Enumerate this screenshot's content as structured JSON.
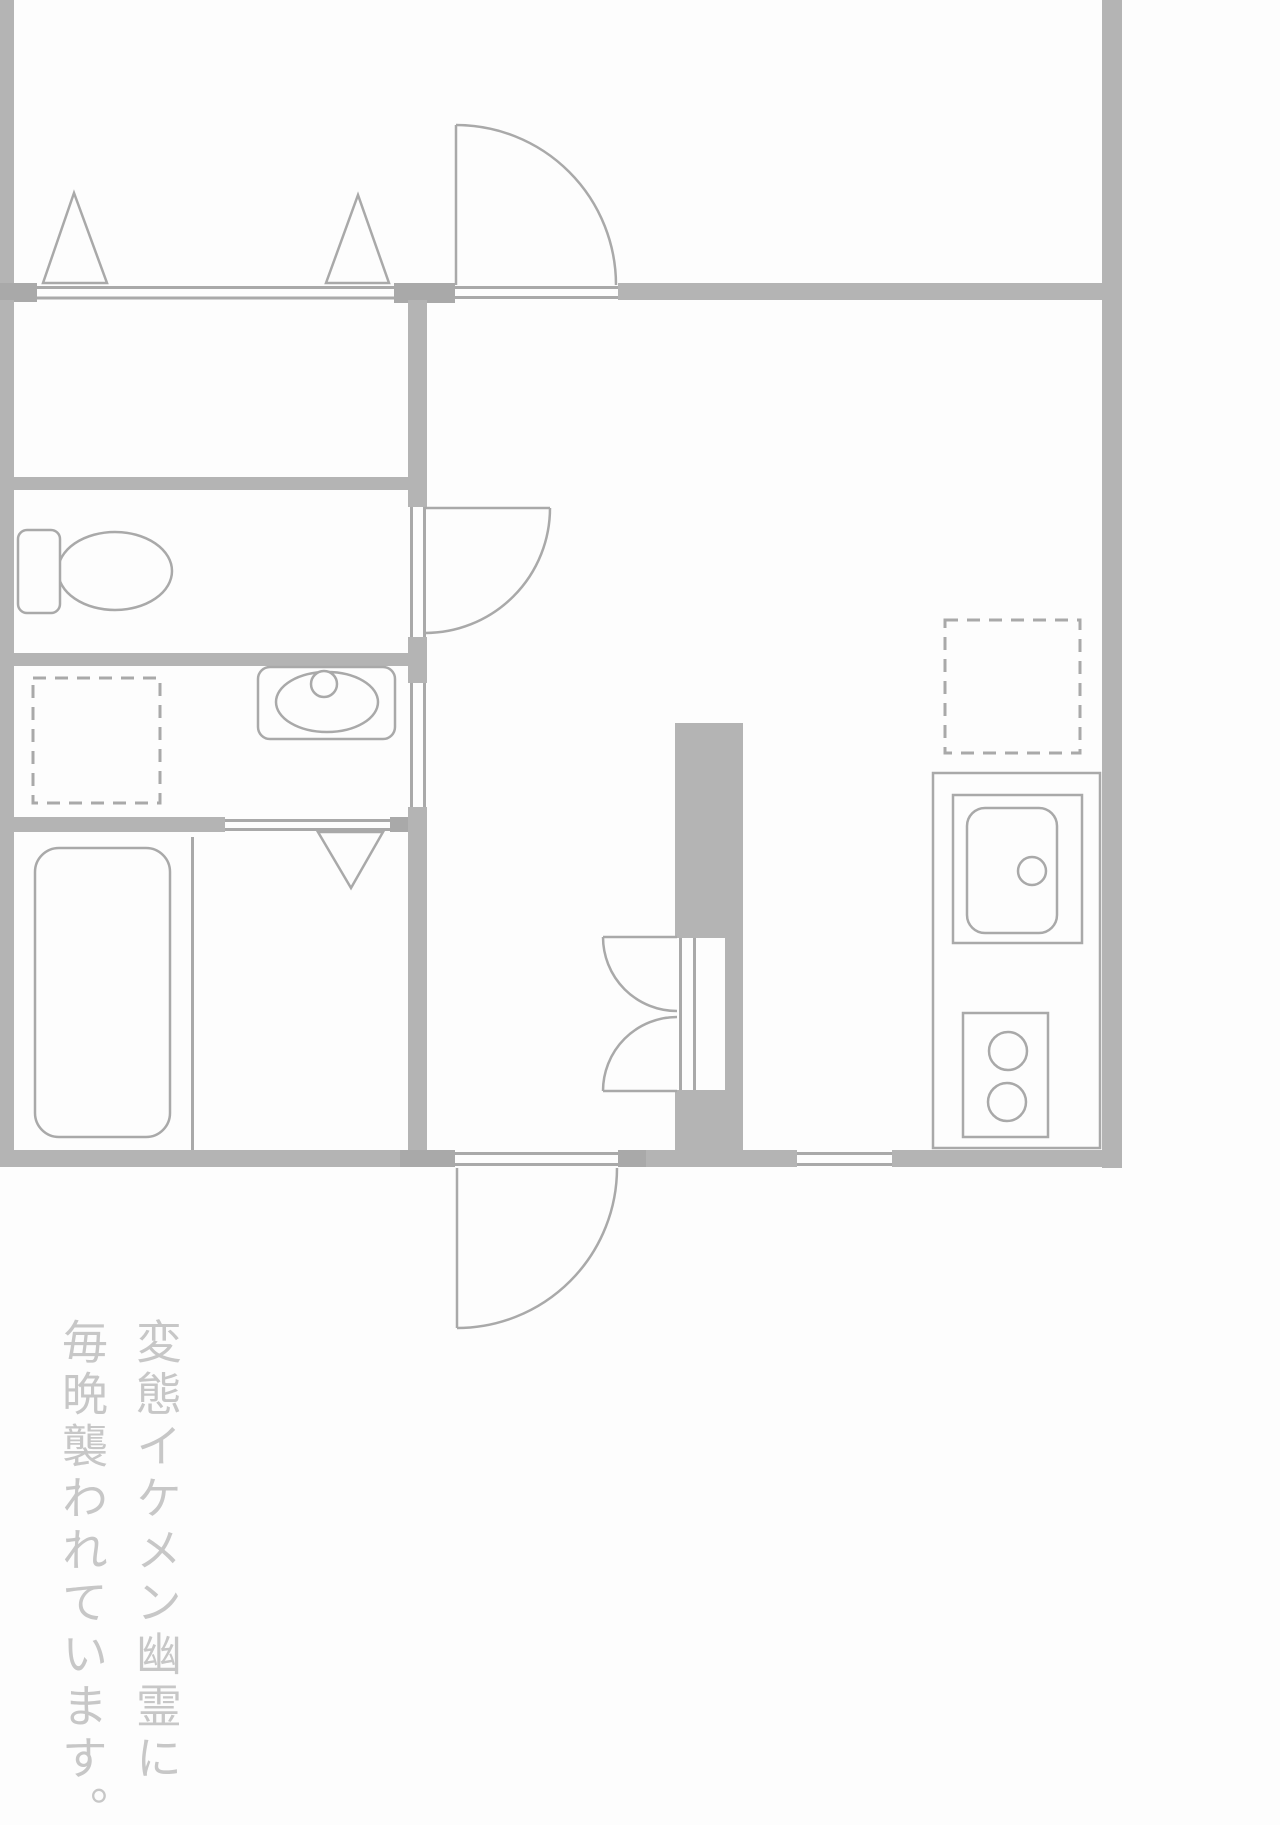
{
  "page": {
    "width_px": 1280,
    "height_px": 1825,
    "background": "#fdfdfd"
  },
  "floor_plan": {
    "type": "apartment-floor-plan",
    "wall_color": "#b4b4b4",
    "pillar_color": "#a9a9a9",
    "line_color": "#a9a9a9",
    "fixture_fill": "#fdfdfd",
    "symbols": [
      "closet-folding-door-triangles",
      "entrance-door-swing",
      "toilet",
      "toilet-door-swing",
      "washbasin",
      "washing-machine-space-dashed",
      "bathtub",
      "bathroom-folding-door-triangle",
      "closet-double-doors",
      "kitchen-sink-counter",
      "gas-stove-two-burners",
      "refrigerator-space-dashed",
      "kitchen-window",
      "back-door-swing"
    ]
  },
  "caption": {
    "orientation": "vertical-rl",
    "lines": [
      "変態イケメン幽霊に",
      "毎晩襲われています。"
    ],
    "full_text": "変態イケメン幽霊に毎晩襲われています。",
    "color": "#c7c7c7"
  }
}
